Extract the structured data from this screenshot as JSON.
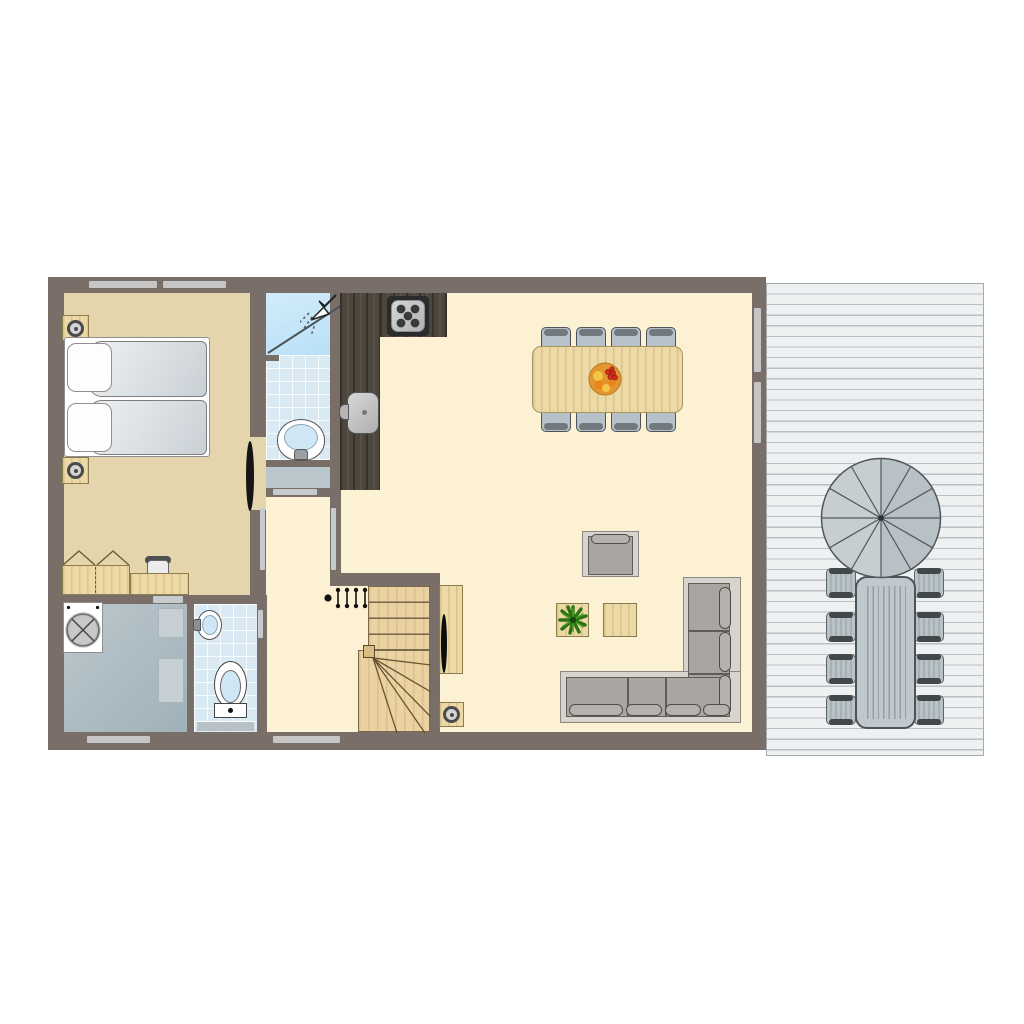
{
  "diagram": {
    "type": "floor-plan",
    "subject": "holiday-home ground floor with terrace, top-down view, no text labels",
    "rooms": [
      {
        "name": "bedroom",
        "floor": "tan",
        "furniture": [
          "double-bed",
          "pillow",
          "pillow",
          "duvet",
          "duvet",
          "nightstand-with-lamp",
          "nightstand-with-lamp",
          "wardrobe-open-doors",
          "desk",
          "desk-chair"
        ]
      },
      {
        "name": "shower-room",
        "floor": "blue-tile",
        "furniture": [
          "shower-cubicle",
          "shower-head",
          "glass-door",
          "washbasin-with-tap"
        ]
      },
      {
        "name": "storage-niche",
        "floor": "gray",
        "furniture": []
      },
      {
        "name": "hallway",
        "floor": "cream",
        "furniture": [
          "coat-rack"
        ]
      },
      {
        "name": "kitchen",
        "floor": "cream",
        "furniture": [
          "l-shaped-dark-counter",
          "hob",
          "kitchen-sink-with-tap"
        ]
      },
      {
        "name": "living-dining-room",
        "floor": "cream",
        "furniture": [
          "dining-table",
          "dining-chairs",
          "fruit-bowl",
          "armchair",
          "corner-sofa",
          "plant-table",
          "potted-plant",
          "side-table",
          "tv-cabinet",
          "tv",
          "lamp-table"
        ]
      },
      {
        "name": "staircase",
        "floor": "wood",
        "furniture": [
          "straight-flight",
          "winder-steps",
          "newel-post"
        ]
      },
      {
        "name": "utility-room",
        "floor": "gray-blue",
        "furniture": [
          "washing-machine",
          "shelf",
          "shelf"
        ]
      },
      {
        "name": "toilet-room",
        "floor": "blue-tile",
        "furniture": [
          "toilet",
          "hand-basin",
          "vanity-shelf"
        ]
      },
      {
        "name": "terrace",
        "floor": "gray-deck-planks",
        "furniture": [
          "parasol",
          "outdoor-table",
          "outdoor-chairs"
        ]
      }
    ],
    "counts": {
      "dining_chairs": 8,
      "terrace_chairs": 8,
      "hob_burners": 5,
      "coat_hooks": 4,
      "bed_places": 2,
      "parasol_segments": 12,
      "sofa_back_pillows": 3,
      "sofa_seat_pillows": 4
    },
    "openings": {
      "top_wall_windows": 2,
      "bottom_wall_windows": 2,
      "terrace_sliding_doors": 2,
      "interior_door_slits": 5,
      "bedroom_door_leaf": 1
    },
    "colors": {
      "wall": "#796f68",
      "bedroom_floor": "#e4d5ac",
      "living_floor": "#fcf1d3",
      "tile_floor": "#d9eaf4",
      "shower_cubicle": "#c2e4f7",
      "utility_floor": "#aebcc3",
      "terrace_deck": "#eef1f2",
      "wood_furniture": "#ecd9a5",
      "kitchen_counter": "#4d463d",
      "upholstery_gray": "#a9a5a1",
      "dining_chair_gray": "#b6c1c9",
      "outdoor_gray": "#bfc9cd",
      "window_glass": "#c6c6c6",
      "fruit_bowl_orange": "#e2962f",
      "fruit_red": "#cf2b20",
      "plant_green": "#3f8f1f"
    }
  }
}
